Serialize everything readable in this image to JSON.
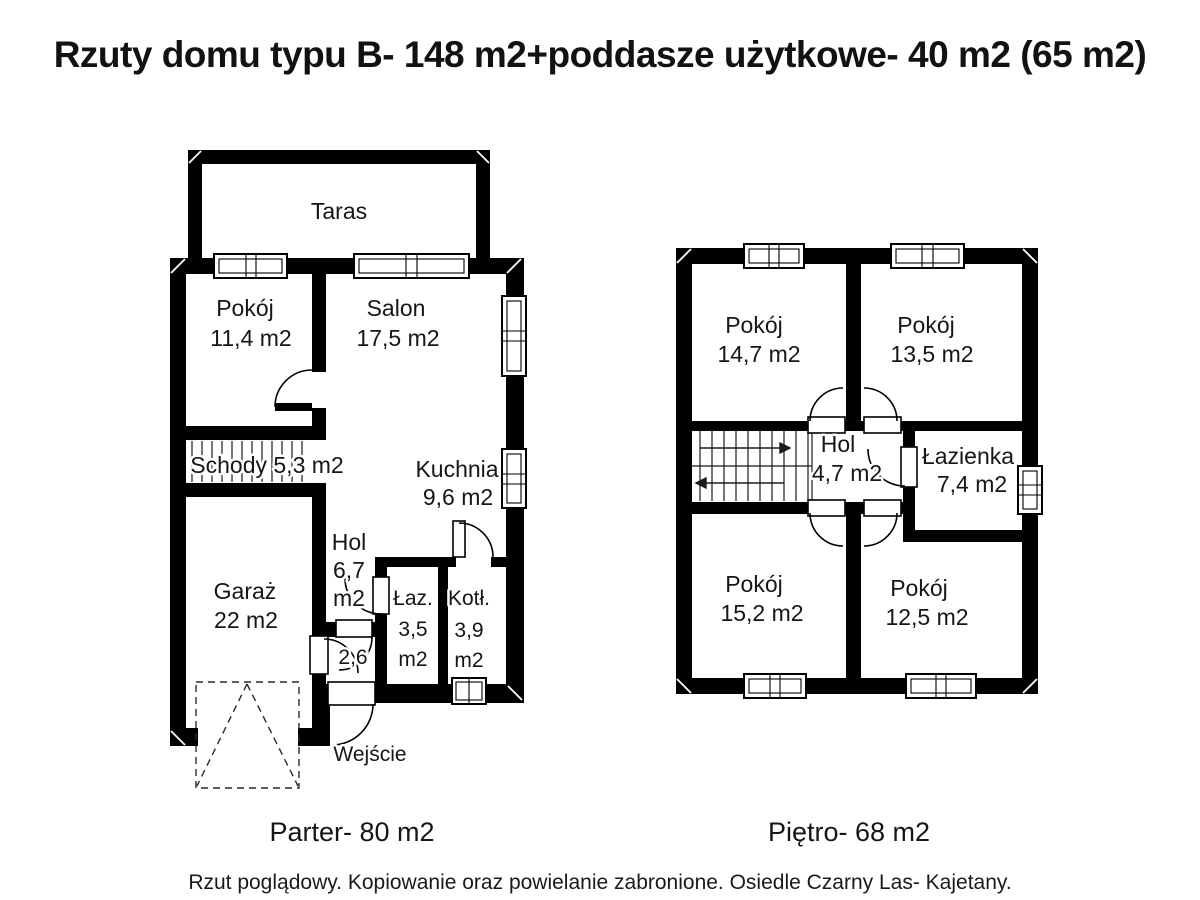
{
  "title": "Rzuty domu typu B- 148 m2+poddasze użytkowe- 40 m2 (65 m2)",
  "footer": "Rzut poglądowy. Kopiowanie oraz powielanie zabronione. Osiedle Czarny Las- Kajetany.",
  "colors": {
    "wall": "#000000",
    "background": "#ffffff",
    "ink": "#161616"
  },
  "ground_floor": {
    "caption": "Parter- 80 m2",
    "rooms": {
      "taras": {
        "name": "Taras"
      },
      "pokoj": {
        "name": "Pokój",
        "area": "11,4 m2"
      },
      "salon": {
        "name": "Salon",
        "area": "17,5 m2"
      },
      "schody": {
        "label": "Schody 5,3 m2"
      },
      "kuchnia": {
        "name": "Kuchnia",
        "area": "9,6 m2"
      },
      "garaz": {
        "name": "Garaż",
        "area": "22 m2"
      },
      "hol": {
        "name": "Hol",
        "area_value": "6,7",
        "area_unit": "m2"
      },
      "wiatrolap": {
        "area": "2,6"
      },
      "lazienka": {
        "name": "Łaz.",
        "area_value": "3,5",
        "area_unit": "m2"
      },
      "kotlownia": {
        "name": "Kotł.",
        "area_value": "3,9",
        "area_unit": "m2"
      },
      "wejscie": {
        "label": "Wejście"
      }
    }
  },
  "upper_floor": {
    "caption": "Piętro- 68 m2",
    "rooms": {
      "pokoj_nw": {
        "name": "Pokój",
        "area": "14,7 m2"
      },
      "pokoj_ne": {
        "name": "Pokój",
        "area": "13,5 m2"
      },
      "hol": {
        "name": "Hol",
        "area": "4,7 m2"
      },
      "lazienka": {
        "name": "Łazienka",
        "area": "7,4 m2"
      },
      "pokoj_sw": {
        "name": "Pokój",
        "area": "15,2 m2"
      },
      "pokoj_se": {
        "name": "Pokój",
        "area": "12,5 m2"
      }
    }
  }
}
